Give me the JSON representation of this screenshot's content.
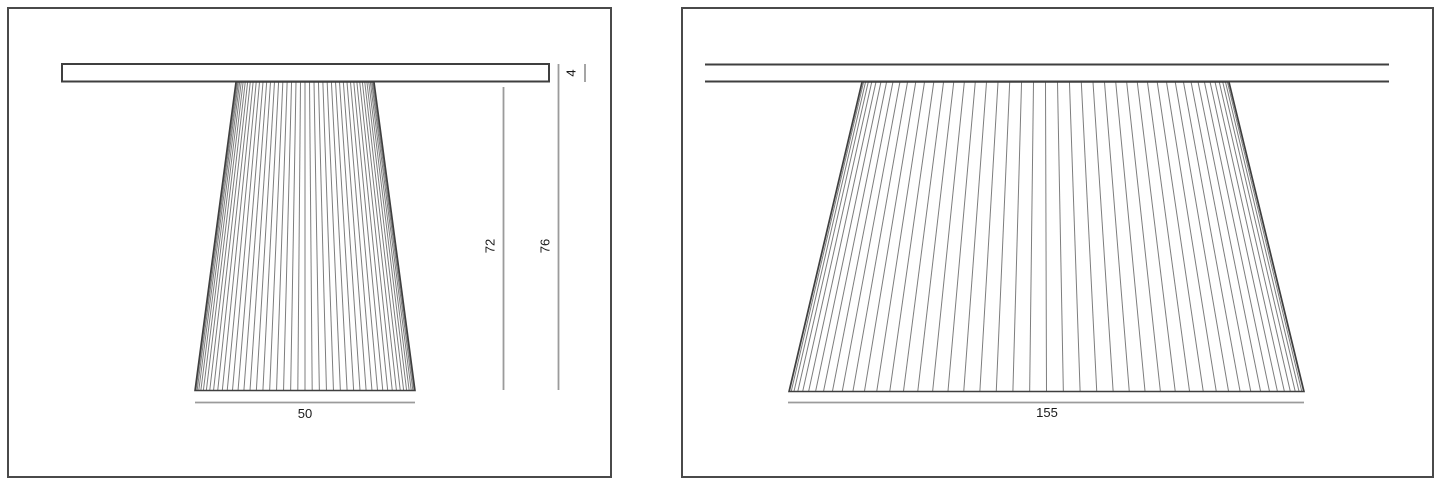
{
  "document": {
    "kind": "furniture-dimension-sheet",
    "views": [
      "pedestal-table-small-view",
      "pedestal-table-large-view"
    ]
  },
  "colors": {
    "frame": "#4a4a4a",
    "outline": "#3f3f3f",
    "flute": "#7d7d7d",
    "dimension": "#9b9b9b",
    "label": "#1a1a1a",
    "paper": "#ffffff"
  },
  "left_view": {
    "dim_top_thickness": "4",
    "dim_pedestal_height": "72",
    "dim_total_height": "76",
    "dim_base_width": "50"
  },
  "right_view": {
    "dim_base_width": "155"
  }
}
